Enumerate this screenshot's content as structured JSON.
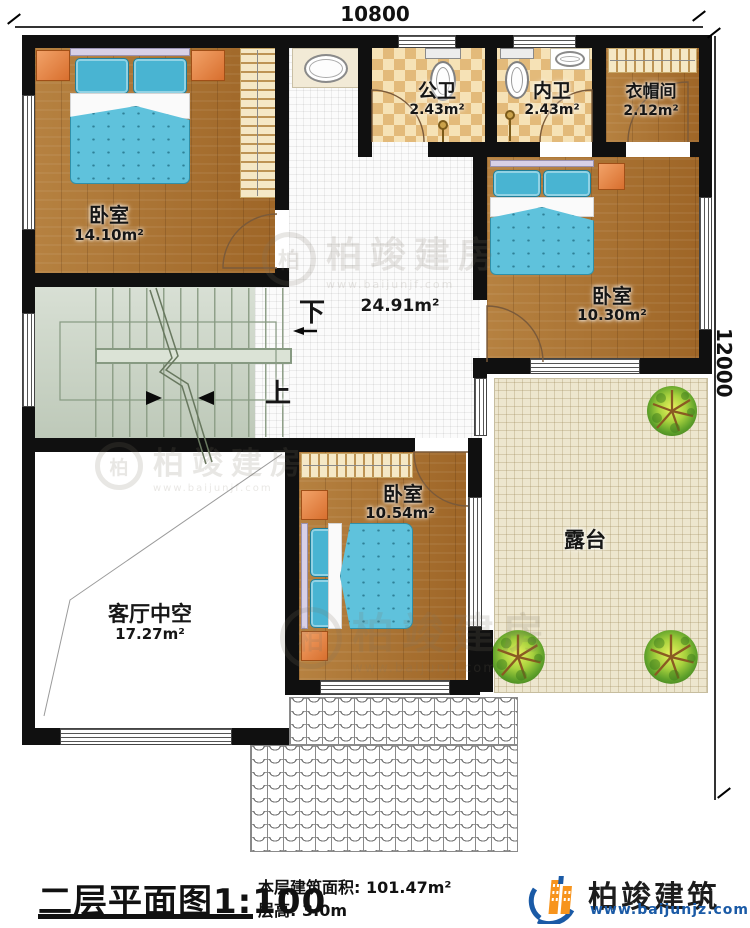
{
  "plan": {
    "dimensions": {
      "width_mm": "10800",
      "height_mm": "12000"
    },
    "rooms": {
      "bedroom_top_left": {
        "name": "卧室",
        "area": "14.10m²"
      },
      "public_bath": {
        "name": "公卫",
        "area": "2.43m²"
      },
      "private_bath": {
        "name": "内卫",
        "area": "2.43m²"
      },
      "cloakroom": {
        "name": "衣帽间",
        "area": "2.12m²"
      },
      "bedroom_right": {
        "name": "卧室",
        "area": "10.30m²"
      },
      "hall": {
        "area": "24.91m²"
      },
      "bedroom_bottom": {
        "name": "卧室",
        "area": "10.54m²"
      },
      "living_void": {
        "name": "客厅中空",
        "area": "17.27m²"
      },
      "terrace": {
        "name": "露台"
      }
    },
    "stairs": {
      "down": "下",
      "up": "上"
    }
  },
  "titleblock": {
    "title": "二层平面图",
    "scale": "1:100",
    "area_label": "本层建筑面积:",
    "area_value": "101.47m²",
    "height_label": "层高:",
    "height_value": "3.0m"
  },
  "brand": {
    "name": "柏竣建筑",
    "website": "www.baijunjz.com"
  },
  "watermark": {
    "name": "柏竣建房",
    "website": "www.baijunjf.com",
    "initial": "柏"
  },
  "colors": {
    "wall": "#101010",
    "accent_blue": "#1a5aa6",
    "accent_orange": "#f7941d"
  }
}
